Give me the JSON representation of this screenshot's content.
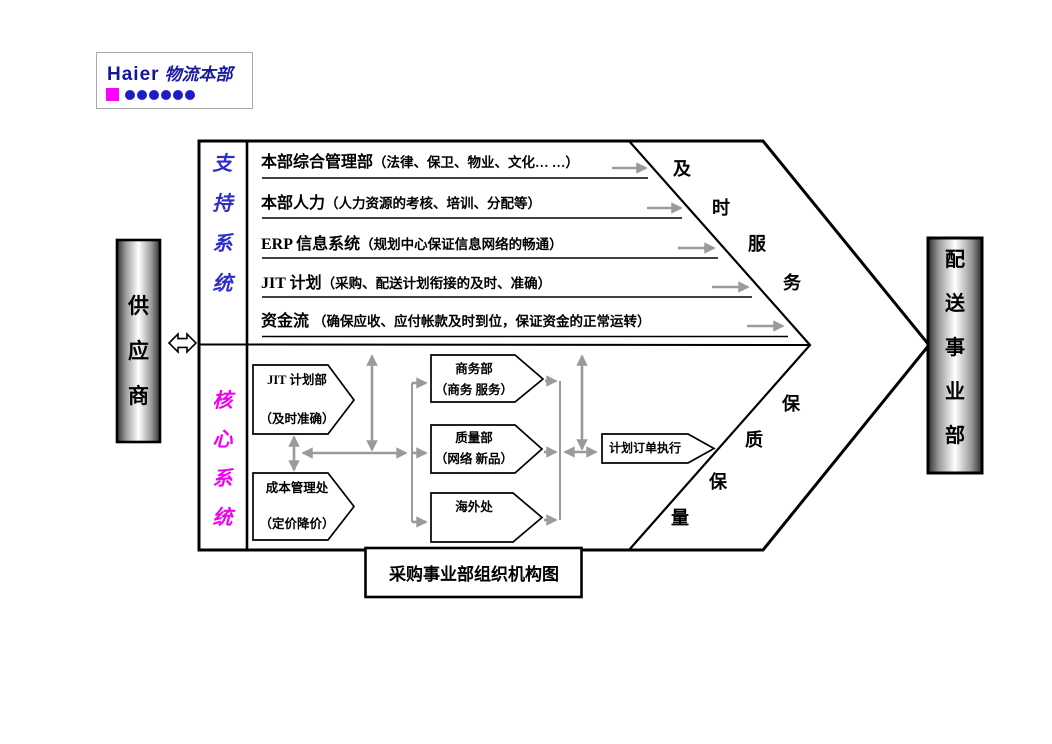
{
  "logo": {
    "brand": "Haier",
    "division": "物流本部",
    "brand_color": "#16169B",
    "square_color": "#FF00FF",
    "dot_color": "#1C1CC8",
    "dot_count": 6
  },
  "supplier": {
    "label": "供应商"
  },
  "distribution": {
    "label": "配送事业部"
  },
  "support": {
    "label": "支持系统",
    "label_color": "#2D2DC8",
    "rows": [
      {
        "head": "本部综合管理部",
        "detail": "（法律、保卫、物业、文化… …）"
      },
      {
        "head": "本部人力",
        "detail": "（人力资源的考核、培训、分配等）"
      },
      {
        "head": "ERP 信息系统",
        "detail": "（规划中心保证信息网络的畅通）"
      },
      {
        "head": "JIT 计划",
        "detail": "（采购、配送计划衔接的及时、准确）"
      },
      {
        "head": "资金流 ",
        "detail": "（确保应收、应付帐款及时到位，保证资金的正常运转）"
      }
    ],
    "outcome_chars": [
      "及",
      "时",
      "服",
      "务"
    ]
  },
  "core": {
    "label": "核心系统",
    "label_color": "#F000F0",
    "nodes": {
      "jit": {
        "line1": "JIT 计划部",
        "line2": "（及时准确）"
      },
      "cost": {
        "line1": "成本管理处",
        "line2": "（定价降价）"
      },
      "commerce": {
        "line1": "商务部",
        "line2": "（商务 服务）"
      },
      "quality": {
        "line1": "质量部",
        "line2": "（网络 新品）"
      },
      "overseas": {
        "line1": "海外处"
      },
      "order": {
        "line1": "计划订单执行"
      }
    },
    "outcome_chars": [
      "保",
      "质",
      "保",
      "量"
    ]
  },
  "caption": "采购事业部组织机构图",
  "colors": {
    "connector_gray": "#9A9A9A",
    "outline_black": "#000000",
    "gradient_edge": "#2E2E2E"
  }
}
